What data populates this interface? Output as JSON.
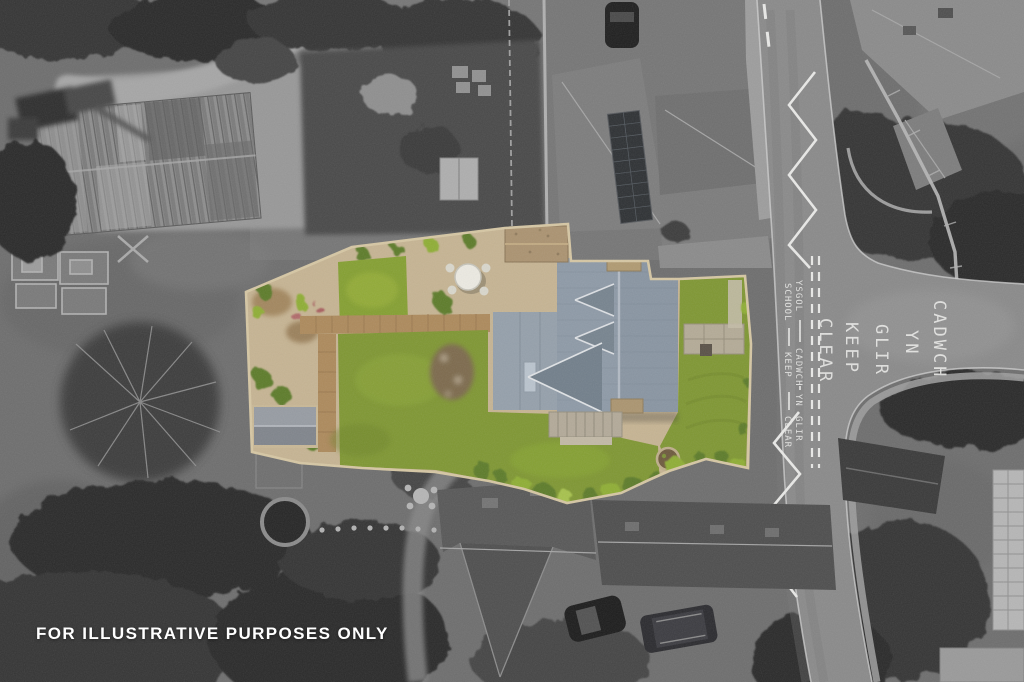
{
  "caption": {
    "text": "FOR ILLUSTRATIVE PURPOSES ONLY"
  },
  "road_markings": {
    "junction_words": [
      "CLEAR",
      "KEEP",
      "GLIR",
      "YN",
      "CADWCH"
    ],
    "edge_english": [
      "SCHOOL",
      "KEEP",
      "CLEAR"
    ],
    "edge_welsh": [
      "YSGOL",
      "CADWCH",
      "YN",
      "GLIR"
    ]
  },
  "palette": {
    "greyscale_base": "#717171",
    "lawn_green": "#7f9733",
    "gravel_tan": "#c6b493",
    "brick_path": "#ad8a5c",
    "slate_roof_blue_grey": "#8995a2",
    "road_marking_white": "#e9e9e7",
    "caption_white": "#ffffff"
  }
}
